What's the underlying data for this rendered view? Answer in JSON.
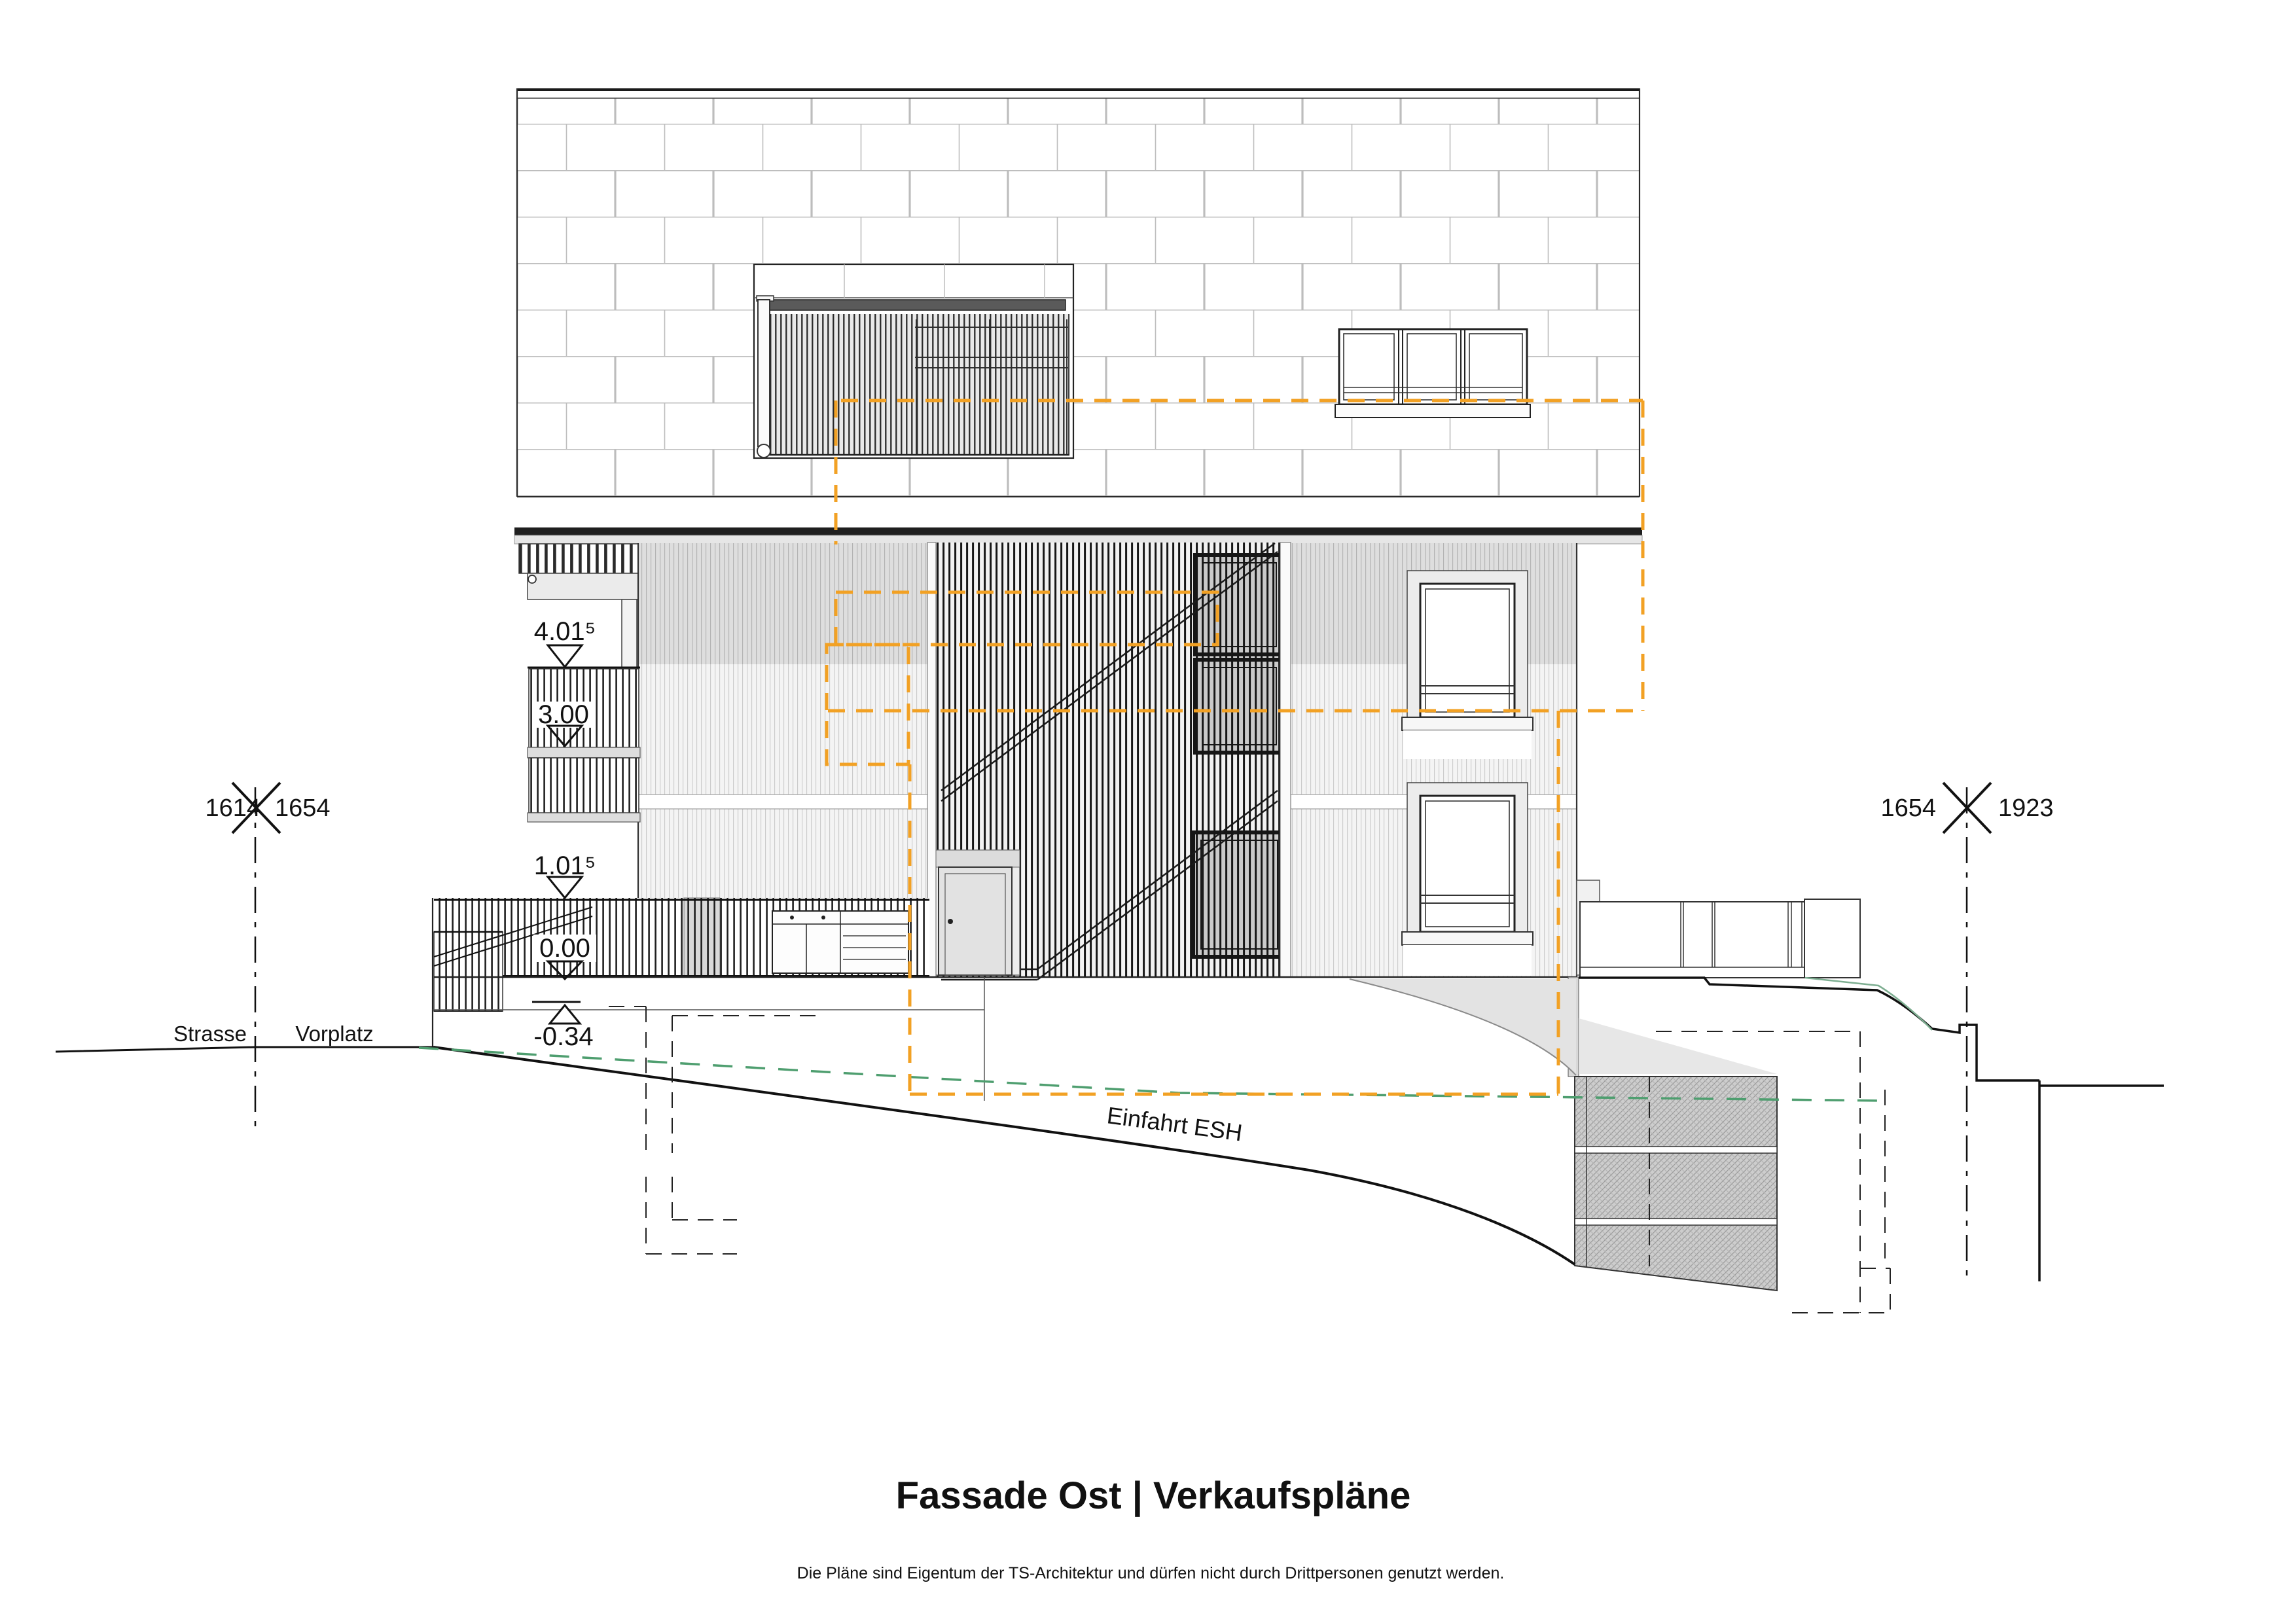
{
  "drawing": {
    "title": "Fassade Ost | Verkaufspläne",
    "disclaimer": "Die Pläne sind Eigentum der TS-Architektur und dürfen nicht durch Drittpersonen genutzt werden."
  },
  "levels": {
    "attic_top": "4.01⁵",
    "attic_floor": "3.00",
    "upper_floor": "1.01⁵",
    "entry": "0.00",
    "grade": "-0.34"
  },
  "site": {
    "street": "Strasse",
    "forecourt": "Vorplatz",
    "driveway": "Einfahrt ESH"
  },
  "parcels": {
    "left": {
      "west": "1614",
      "east": "1654"
    },
    "right": {
      "west": "1654",
      "east": "1923"
    }
  },
  "colors": {
    "unit-overlay": "#F2A124",
    "terrain-existing": "#4E9E6F",
    "line": "#1A1A1A"
  }
}
